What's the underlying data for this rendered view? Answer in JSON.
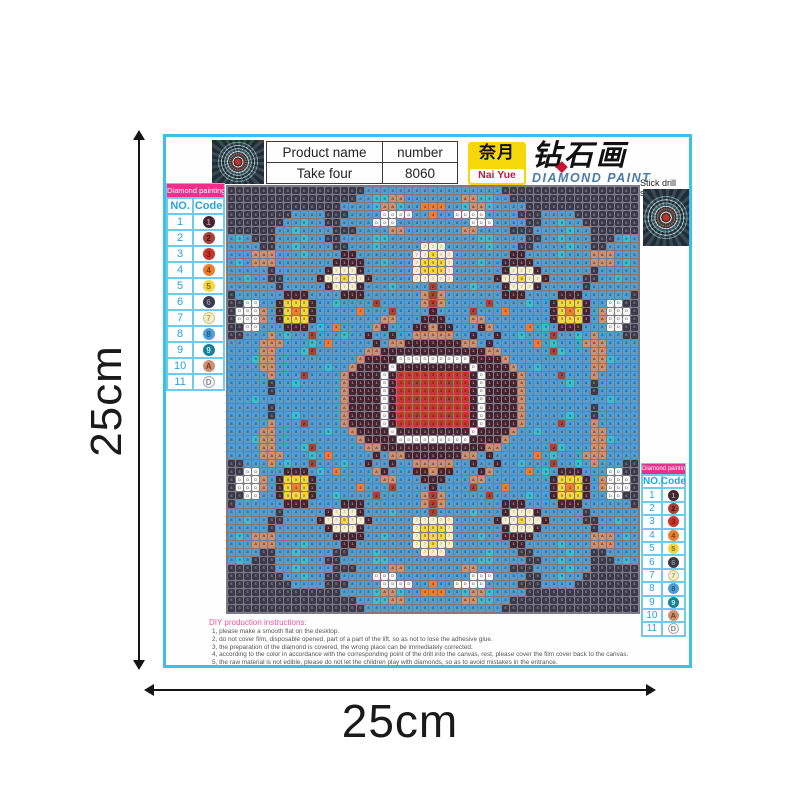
{
  "dimensions": {
    "height_label": "25cm",
    "width_label": "25cm"
  },
  "header": {
    "table": {
      "product_name_label": "Product name",
      "number_label": "number",
      "product_name_value": "Take four",
      "number_value": "8060"
    },
    "logo": {
      "cn": "奈月",
      "en": "Nai Yue",
      "title_cn": "钻石画",
      "subtitle": "DIAMOND PAINT",
      "diamond_icon": "◆",
      "box_color": "#f6d80a",
      "en_color": "#cc1444",
      "subtitle_color": "#4a7ca8"
    },
    "stick_drill_label": "Stick drill site"
  },
  "legend": {
    "title": "Diamond painting",
    "col_no": "NO.",
    "col_code": "Code",
    "rows": [
      {
        "no": "1",
        "code": "1"
      },
      {
        "no": "2",
        "code": "2"
      },
      {
        "no": "3",
        "code": "3"
      },
      {
        "no": "4",
        "code": "4"
      },
      {
        "no": "5",
        "code": "5"
      },
      {
        "no": "6",
        "code": "6"
      },
      {
        "no": "7",
        "code": "7"
      },
      {
        "no": "8",
        "code": "8"
      },
      {
        "no": "9",
        "code": "9"
      },
      {
        "no": "10",
        "code": "A"
      },
      {
        "no": "11",
        "code": "D"
      }
    ]
  },
  "legend_overrides": {
    "9": {
      "bg": "#1a8094",
      "fg": "#bfe8ee"
    }
  },
  "palette": {
    "1": {
      "bg": "#452430",
      "fg": "#bb8f96"
    },
    "2": {
      "bg": "#a84136",
      "fg": "#43120d"
    },
    "3": {
      "bg": "#c8372c",
      "fg": "#7c150e"
    },
    "4": {
      "bg": "#ee7e2e",
      "fg": "#7c3a08"
    },
    "5": {
      "bg": "#f2d83c",
      "fg": "#8a6a10"
    },
    "6": {
      "bg": "#3c3a49",
      "fg": "#8b8899"
    },
    "7": {
      "bg": "#f4efd2",
      "fg": "#c0a93c",
      "br": "#d8c463"
    },
    "8": {
      "bg": "#4f9fd3",
      "fg": "#1c5c88"
    },
    "9": {
      "bg": "#3dbcd3",
      "fg": "#0e6474"
    },
    "A": {
      "bg": "#cd9170",
      "fg": "#6e371c"
    },
    "D": {
      "bg": "#f7f7f5",
      "fg": "#8a8a8a",
      "br": "#aaaaaa"
    }
  },
  "grid": {
    "cols": 51,
    "rows": 53,
    "gap_color": "#7d7b88",
    "quadrant": [
      "66666666666666666888888888",
      "66666666666666668899AA8888",
      "66666666666666",
      "6666666688886668888DDDD884",
      "666666688988668888DDD88888",
      "66666688988886668888AA8888",
      "89866688898866888899888888",
      "88886688988886688898888877",
      "888AAA88898888118888888775",
      "898AAA88888881111889888755",
      "88888688888817771888888755",
      "88988668888177577188888777",
      "88888868888817771888988882",
      "688888811188881118888888A2",
      "66DD88155518898888288888A2",
      "6DDDA815451888884888288881",
      "6DDDA81555188888888AA88811",
      "66DD88811189848888A188811A",
      "66888A89882888988188188AAA",
      "8888AAA8889848888818AA1111",
      "8888AA88892888888AA1111111",
      "8889AA8888888888A1111DDDDD",
      "8888AA888888988A1111D11111",
      "88888A88828888A1111D133333",
      "88888688988888A1111D133233",
      "88888688888888A1111D133333",
      "88898888888888A1111D133233"
    ],
    "quadrant_row2_fix": "6666666666666688889AA98844"
  },
  "instructions": {
    "title": "DIY production instructions:",
    "lines": [
      "1, please make a smooth flat on the desktop.",
      "2, do not cover film, disposable opened, part of a part of the lift, so as not to lose the adhesive glue.",
      "3, the preparation of the diamond is covered, the wrong place can be immediately corrected.",
      "4, according to the color in accordance with the corresponding point of the drill into the canvas, rest, please cover the film cover back to the canvas.",
      "5, the raw material is not edible, please do not let the children play with diamonds, so as to avoid mistakes in the entrance."
    ]
  },
  "colors": {
    "canvas_border": "#3fbfe8",
    "legend_header": "#ec2f8a",
    "legend_text": "#29a3dc",
    "dimension": "#1a1a1a",
    "instructions_title": "#f0559a"
  }
}
